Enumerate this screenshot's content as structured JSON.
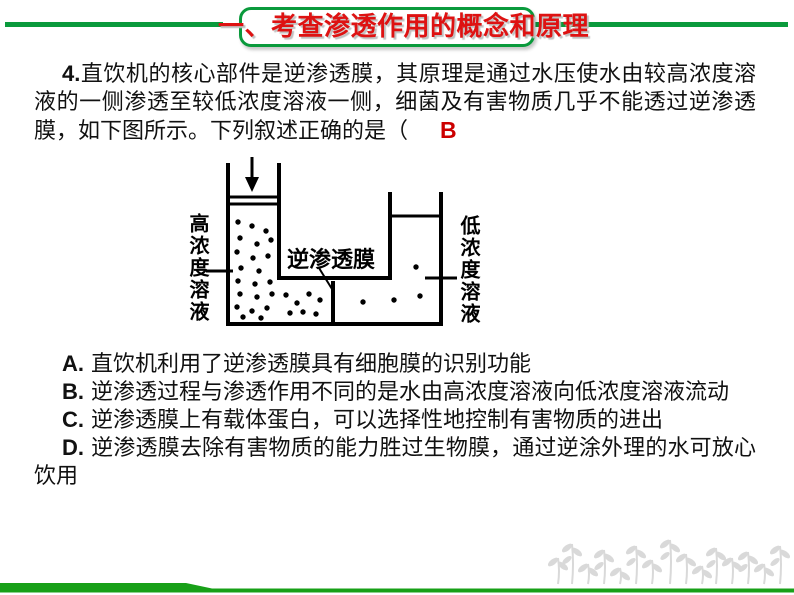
{
  "colors": {
    "green": "#0A9A3C",
    "bar_green": "#18A018",
    "title_red": "#DE1212",
    "answer_red": "#CC0000",
    "plant_gray": "#D9D9D9",
    "text_black": "#111111"
  },
  "header": {
    "title": "一、考查渗透作用的概念和原理"
  },
  "question": {
    "number": "4.",
    "text": "直饮机的核心部件是逆渗透膜，其原理是通过水压使水由较高浓度溶液的一侧渗透至较低浓度溶液一侧，细菌及有害物质几乎不能透过逆渗透膜，如下图所示。下列叙述正确的是（",
    "answer": "B"
  },
  "diagram": {
    "left_label": "高浓度溶液",
    "right_label": "低浓度溶液",
    "membrane_label": "逆渗透膜",
    "dots": {
      "left": [
        [
          238,
          222
        ],
        [
          252,
          226
        ],
        [
          266,
          231
        ],
        [
          240,
          238
        ],
        [
          257,
          244
        ],
        [
          271,
          240
        ],
        [
          237,
          252
        ],
        [
          253,
          258
        ],
        [
          268,
          256
        ],
        [
          241,
          268
        ],
        [
          259,
          271
        ],
        [
          238,
          281
        ],
        [
          255,
          284
        ],
        [
          270,
          282
        ],
        [
          240,
          294
        ],
        [
          257,
          297
        ],
        [
          272,
          294
        ],
        [
          237,
          307
        ],
        [
          252,
          311
        ],
        [
          267,
          308
        ],
        [
          243,
          317
        ],
        [
          261,
          318
        ],
        [
          286,
          295
        ],
        [
          297,
          303
        ],
        [
          309,
          294
        ],
        [
          320,
          300
        ],
        [
          303,
          312
        ],
        [
          316,
          314
        ],
        [
          290,
          313
        ]
      ],
      "right": [
        [
          363,
          302
        ],
        [
          394,
          300
        ],
        [
          420,
          296
        ],
        [
          416,
          267
        ]
      ]
    }
  },
  "options": [
    {
      "label": "A.",
      "text": "直饮机利用了逆渗透膜具有细胞膜的识别功能"
    },
    {
      "label": "B.",
      "text": "逆渗透过程与渗透作用不同的是水由高浓度溶液向低浓度溶液流动"
    },
    {
      "label": "C.",
      "text": "逆渗透膜上有载体蛋白，可以选择性地控制有害物质的进出"
    },
    {
      "label": "D.",
      "text": "逆渗透膜去除有害物质的能力胜过生物膜，通过逆涂外理的水可放心饮用"
    }
  ]
}
